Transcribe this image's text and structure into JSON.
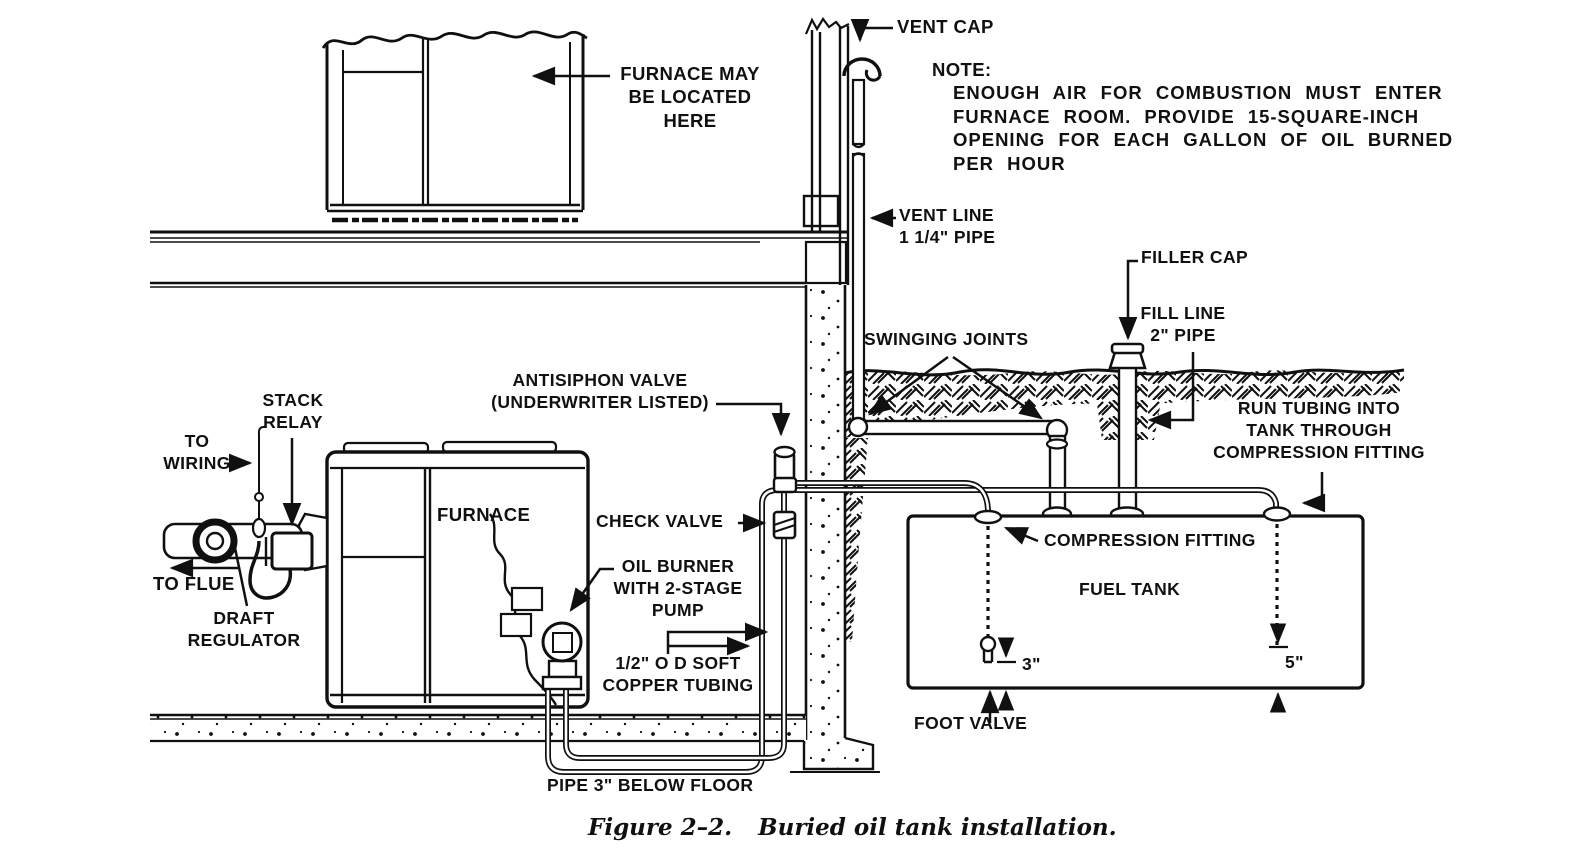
{
  "figure": {
    "caption_figure": "Figure 2–2.",
    "caption_title": "Buried oil tank installation."
  },
  "note": {
    "title": "NOTE:",
    "lines": [
      "ENOUGH AIR FOR COMBUSTION MUST ENTER",
      "FURNACE ROOM. PROVIDE 15-SQUARE-INCH",
      "OPENING FOR EACH GALLON OF OIL BURNED",
      "PER HOUR"
    ]
  },
  "labels": {
    "furnace_location": [
      "FURNACE MAY",
      "BE LOCATED",
      "HERE"
    ],
    "vent_cap": "VENT CAP",
    "vent_line": [
      "VENT LINE",
      "1 1/4\" PIPE"
    ],
    "swinging_joints": "SWINGING JOINTS",
    "filler_cap": "FILLER CAP",
    "fill_line": [
      "FILL LINE",
      "2\" PIPE"
    ],
    "run_tubing": [
      "RUN TUBING INTO",
      "TANK THROUGH",
      "COMPRESSION FITTING"
    ],
    "antisiphon": [
      "ANTISIPHON VALVE",
      "(UNDERWRITER LISTED)"
    ],
    "check_valve": "CHECK VALVE",
    "oil_burner": [
      "OIL BURNER",
      "WITH 2-STAGE",
      "PUMP"
    ],
    "copper_tubing": [
      "1/2\" O D SOFT",
      "COPPER TUBING"
    ],
    "pipe_below_floor": "PIPE 3\" BELOW FLOOR",
    "stack_relay": [
      "STACK",
      "RELAY"
    ],
    "to_wiring": [
      "TO",
      "WIRING"
    ],
    "to_flue": "TO FLUE",
    "draft_regulator": [
      "DRAFT",
      "REGULATOR"
    ],
    "furnace": "FURNACE",
    "fuel_tank": "FUEL TANK",
    "compression_fitting": "COMPRESSION FITTING",
    "foot_valve": "FOOT VALVE",
    "dim_3": "3\"",
    "dim_5": "5\""
  },
  "colors": {
    "ink": "#101010",
    "paper": "#ffffff"
  }
}
